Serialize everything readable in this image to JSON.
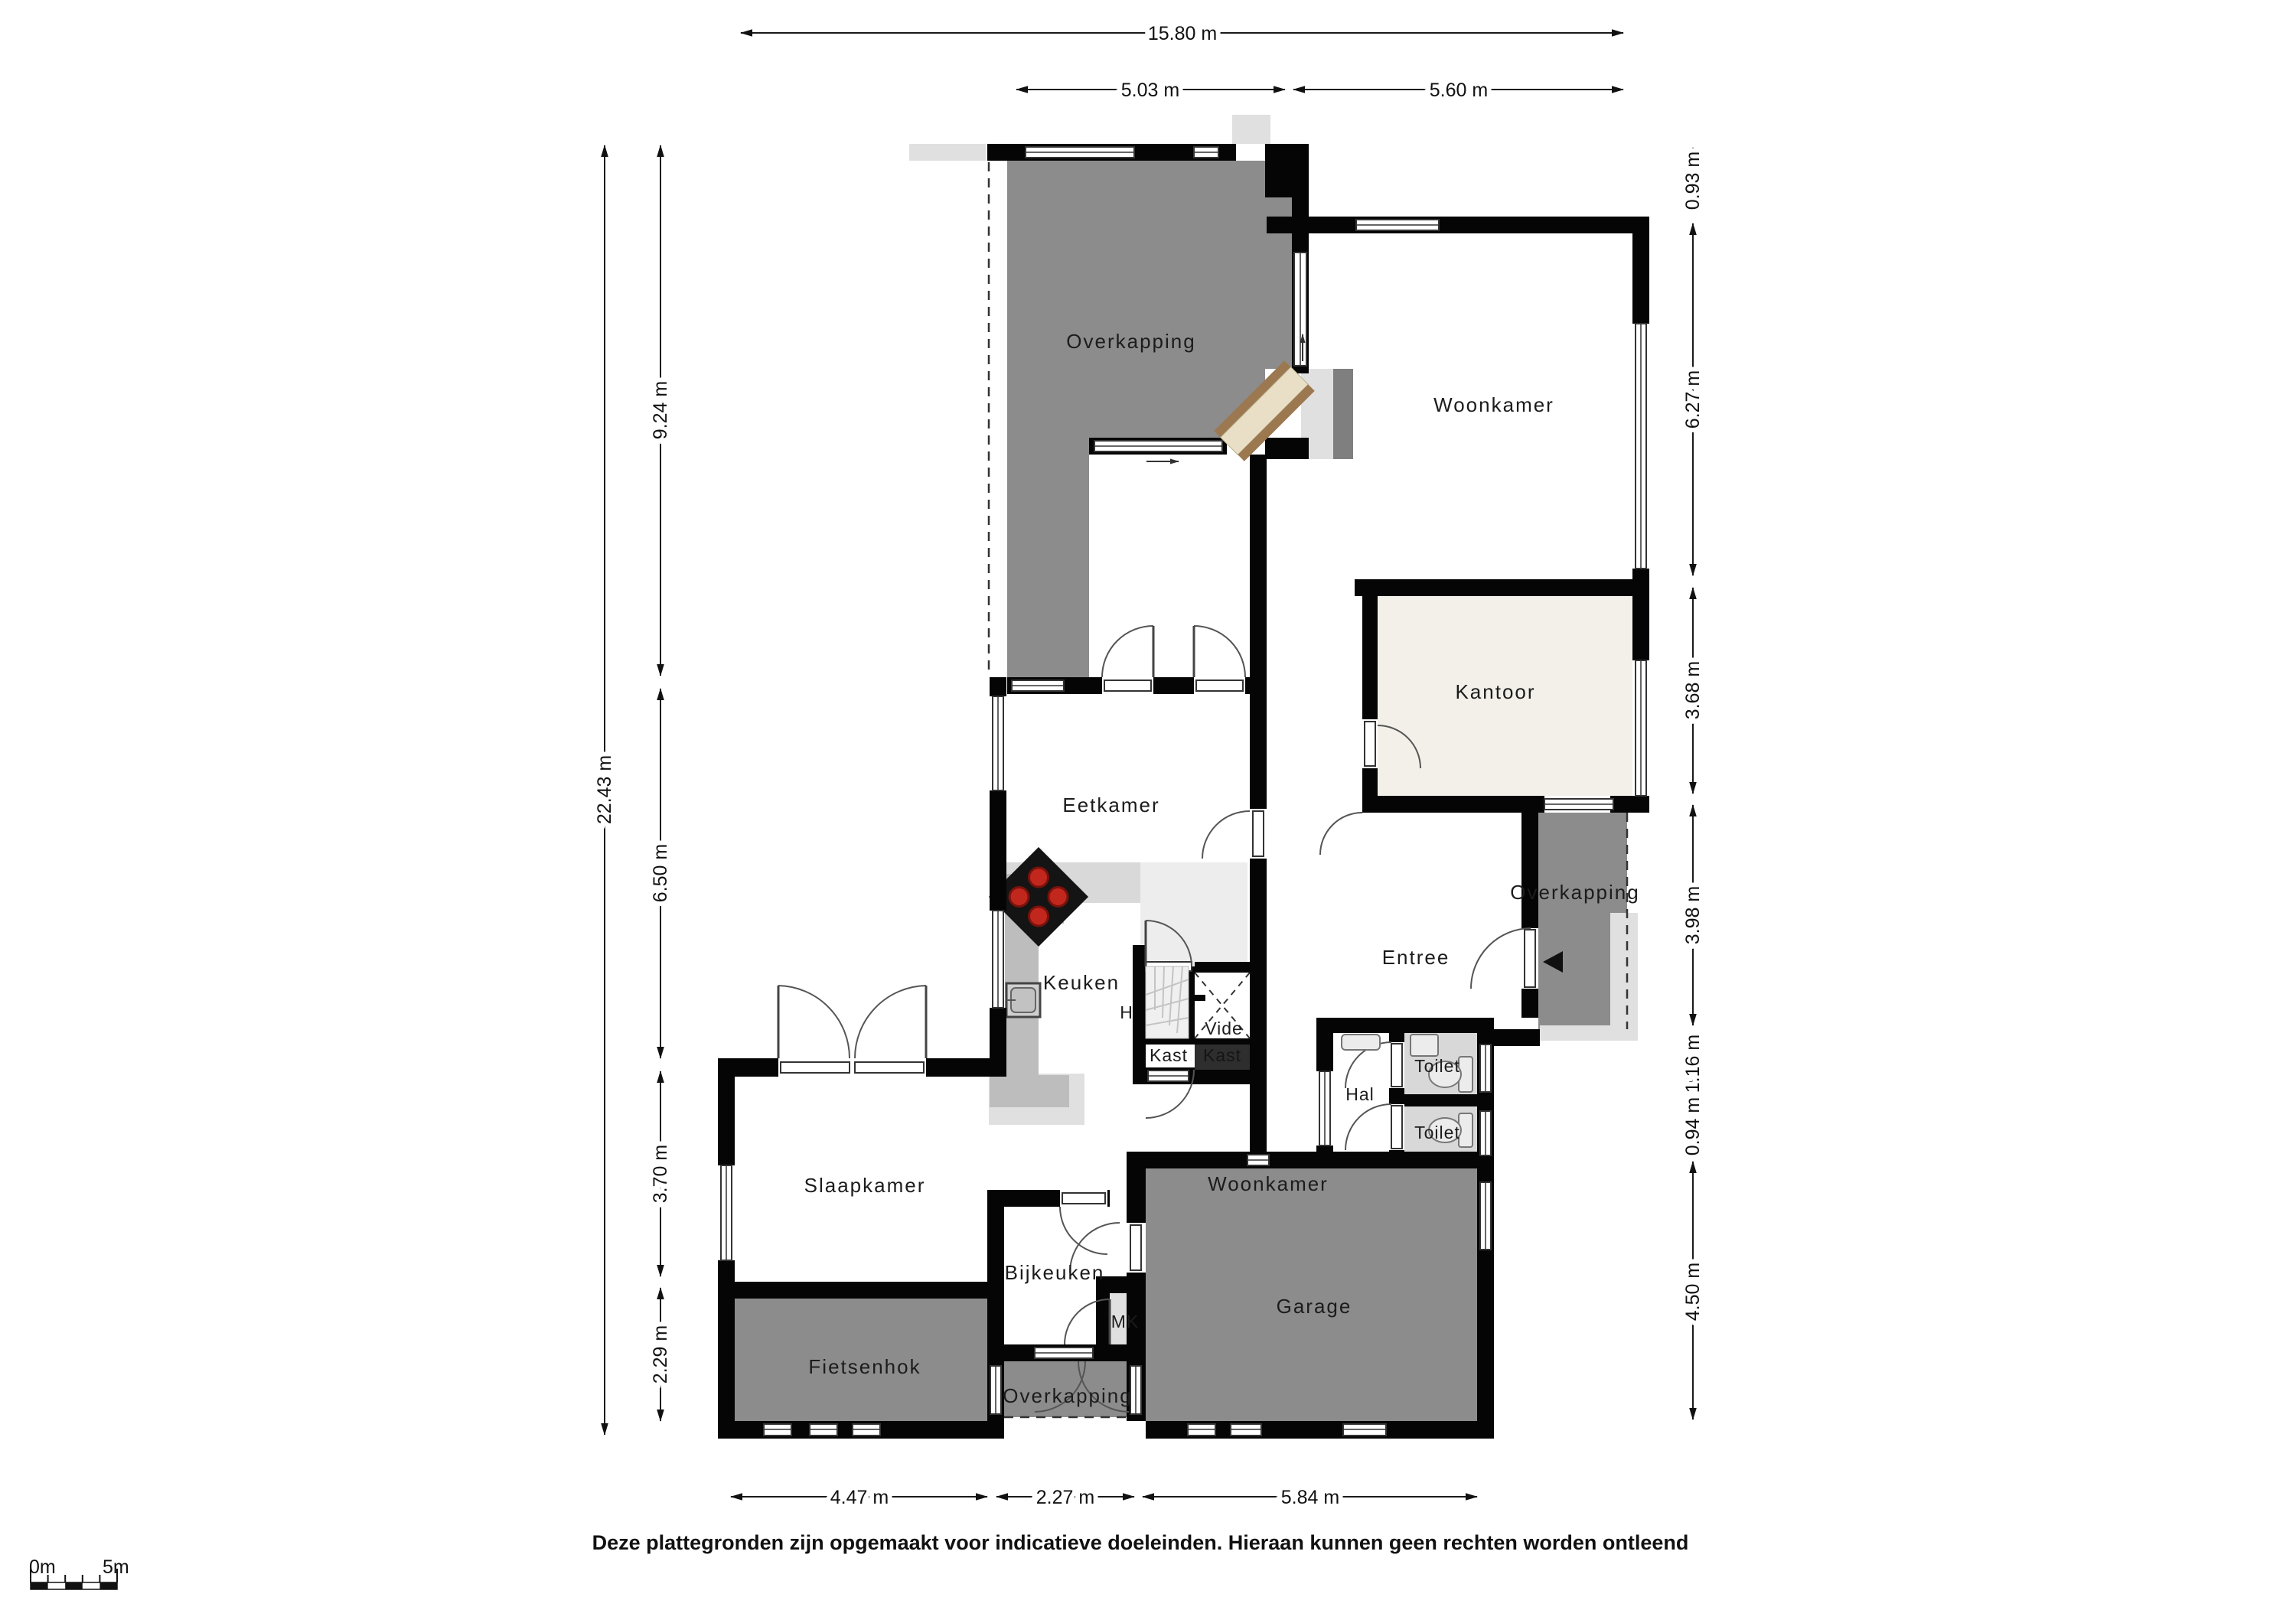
{
  "floorplan": {
    "rooms": {
      "overkapping_top": "Overkapping",
      "woonkamer_top": "Woonkamer",
      "kantoor": "Kantoor",
      "eetkamer": "Eetkamer",
      "keuken": "Keuken",
      "h": "H",
      "vide": "Vide",
      "kast_light": "Kast",
      "kast_dark": "Kast",
      "entree": "Entree",
      "overkapping_right": "Overkapping",
      "hal": "Hal",
      "toilet_top": "Toilet",
      "toilet_bottom": "Toilet",
      "slaapkamer": "Slaapkamer",
      "woonkamer_bottom": "Woonkamer",
      "garage": "Garage",
      "bijkeuken": "Bijkeuken",
      "mk": "MK",
      "fietsenhok": "Fietsenhok",
      "overkapping_bottom": "Overkapping"
    },
    "dimensions": {
      "top": [
        {
          "label": "15.80 m"
        },
        {
          "label": "5.03 m"
        },
        {
          "label": "5.60 m"
        }
      ],
      "left": [
        {
          "label": "22.43 m"
        },
        {
          "label": "9.24 m"
        },
        {
          "label": "6.50 m"
        },
        {
          "label": "3.70 m"
        },
        {
          "label": "2.29 m"
        }
      ],
      "right": [
        {
          "label": "0.93 m"
        },
        {
          "label": "6.27 m"
        },
        {
          "label": "3.68 m"
        },
        {
          "label": "3.98 m"
        },
        {
          "label": "1.16 m"
        },
        {
          "label": "0.94 m"
        },
        {
          "label": "4.50 m"
        }
      ],
      "bottom": [
        {
          "label": "4.47 m"
        },
        {
          "label": "2.27 m"
        },
        {
          "label": "5.84 m"
        }
      ]
    },
    "scale_bar": {
      "start": "0m",
      "end": "5m"
    },
    "disclaimer": "Deze plattegronden zijn opgemaakt voor indicatieve doeleinden. Hieraan kunnen geen rechten worden ontleend",
    "fixtures": {
      "stove": "cooktop-4-burners-icon",
      "sink": "kitchen-sink-icon",
      "wc": "toilet-bowl-icon",
      "stairs": "winder-stairs-icon",
      "radiator": "radiator-icon",
      "entrance_arrow": "entrance-arrow-icon"
    },
    "colors": {
      "wall": "#050505",
      "covered_area_gray": "#8c8c8c",
      "office_cream": "#f3f0e9",
      "toilet_gray": "#d8d8d8",
      "counter_gray": "#bdbdbd",
      "accent_light": "#e0e0e0",
      "step_brown": "#9b7850",
      "step_beige": "#e9dfc6",
      "burner_red": "#c2271d"
    }
  }
}
